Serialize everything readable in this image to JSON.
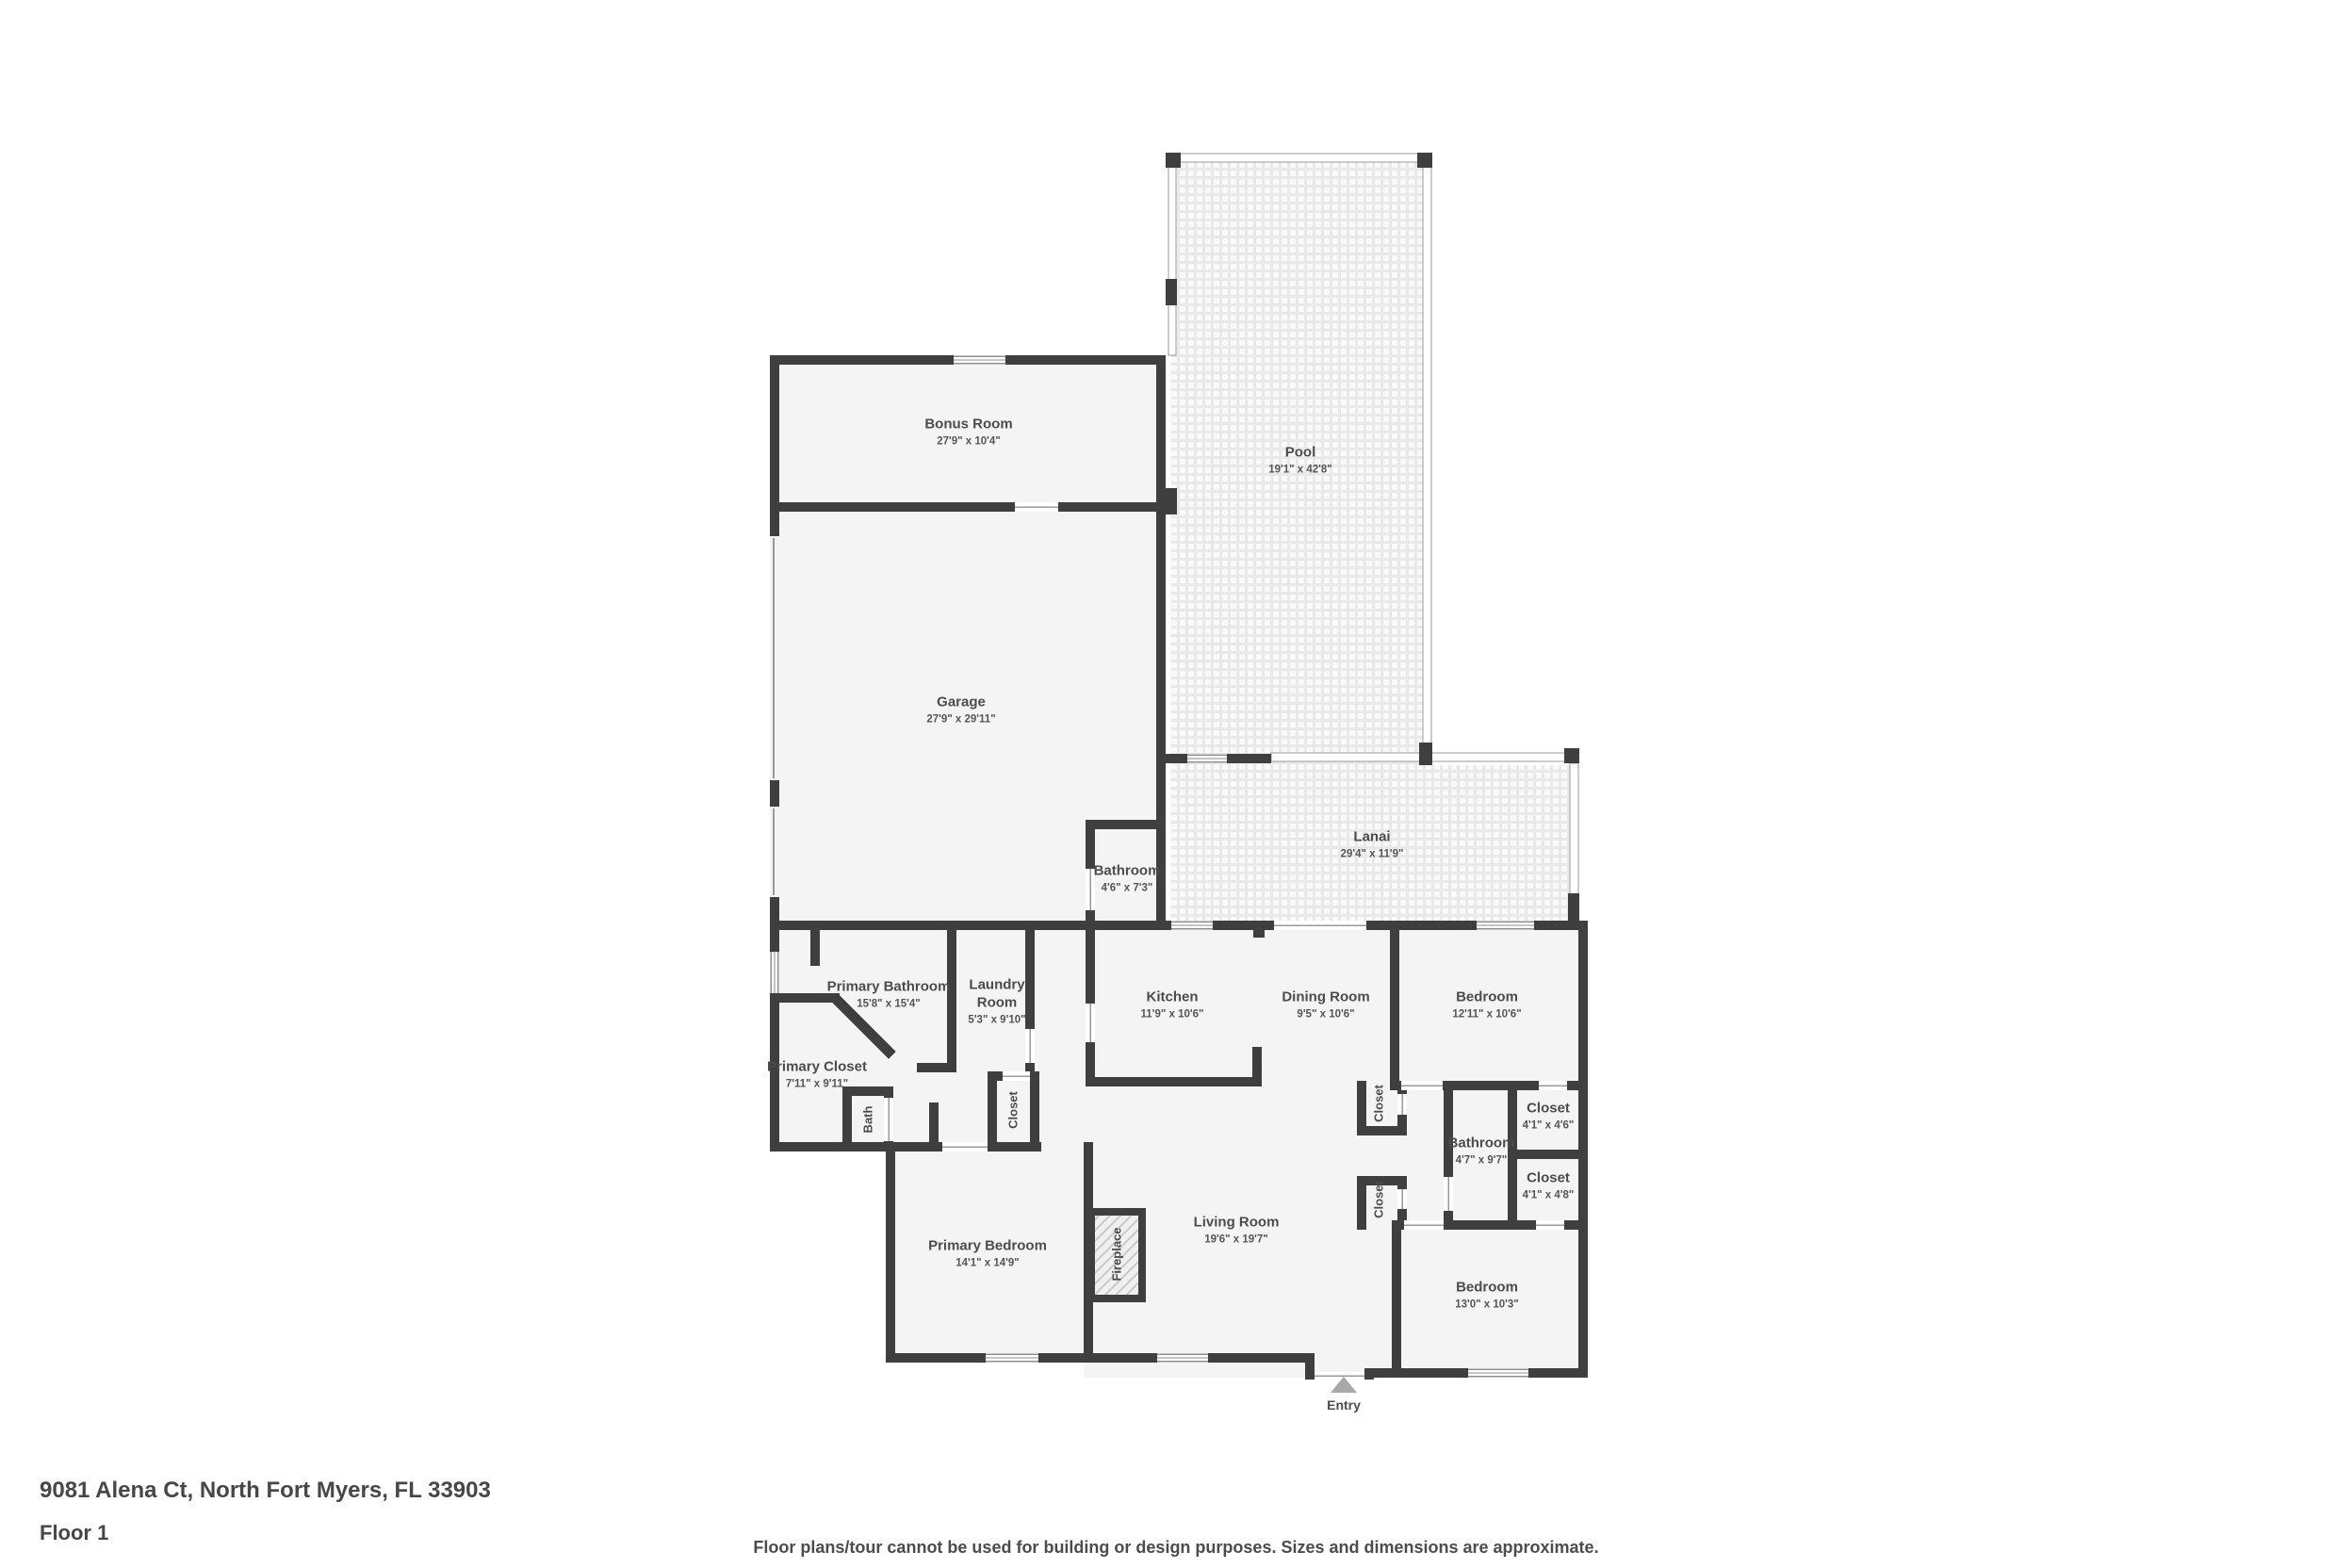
{
  "colors": {
    "wall": "#3f3f3f",
    "room_fill": "#f4f4f4",
    "screen_line": "#9a9a9a",
    "label_text": "#4c4c4c",
    "entry_arrow": "#a8a8a8"
  },
  "rooms": {
    "bonus_room": {
      "name": "Bonus Room",
      "dims": "27'9\" x 10'4\""
    },
    "pool": {
      "name": "Pool",
      "dims": "19'1\" x 42'8\""
    },
    "garage": {
      "name": "Garage",
      "dims": "27'9\" x 29'11\""
    },
    "bathroom_garage": {
      "name": "Bathroom",
      "dims": "4'6\" x 7'3\""
    },
    "lanai": {
      "name": "Lanai",
      "dims": "29'4\" x 11'9\""
    },
    "primary_bathroom": {
      "name": "Primary Bathroom",
      "dims": "15'8\" x 15'4\""
    },
    "laundry_room": {
      "name": "Laundry Room",
      "dims": "5'3\" x 9'10\""
    },
    "kitchen": {
      "name": "Kitchen",
      "dims": "11'9\" x 10'6\""
    },
    "dining_room": {
      "name": "Dining Room",
      "dims": "9'5\" x 10'6\""
    },
    "bedroom_1": {
      "name": "Bedroom",
      "dims": "12'11\" x 10'6\""
    },
    "primary_closet": {
      "name": "Primary Closet",
      "dims": "7'11\" x 9'11\""
    },
    "bath": {
      "name": "Bath",
      "dims": ""
    },
    "closet_hall": {
      "name": "Closet",
      "dims": ""
    },
    "closet_dining": {
      "name": "Closet",
      "dims": ""
    },
    "closet_living": {
      "name": "Closet",
      "dims": ""
    },
    "bathroom_2": {
      "name": "Bathroom",
      "dims": "4'7\" x 9'7\""
    },
    "closet_top": {
      "name": "Closet",
      "dims": "4'1\" x 4'6\""
    },
    "closet_bottom": {
      "name": "Closet",
      "dims": "4'1\" x 4'8\""
    },
    "primary_bedroom": {
      "name": "Primary Bedroom",
      "dims": "14'1\" x 14'9\""
    },
    "fireplace": {
      "name": "Fireplace",
      "dims": ""
    },
    "living_room": {
      "name": "Living Room",
      "dims": "19'6\" x 19'7\""
    },
    "bedroom_2": {
      "name": "Bedroom",
      "dims": "13'0\" x 10'3\""
    }
  },
  "entry": {
    "label": "Entry"
  },
  "footer": {
    "address": "9081 Alena Ct, North Fort Myers, FL 33903",
    "floor_label": "Floor 1",
    "disclaimer": "Floor plans/tour cannot be used for building or design purposes. Sizes and dimensions are approximate."
  }
}
